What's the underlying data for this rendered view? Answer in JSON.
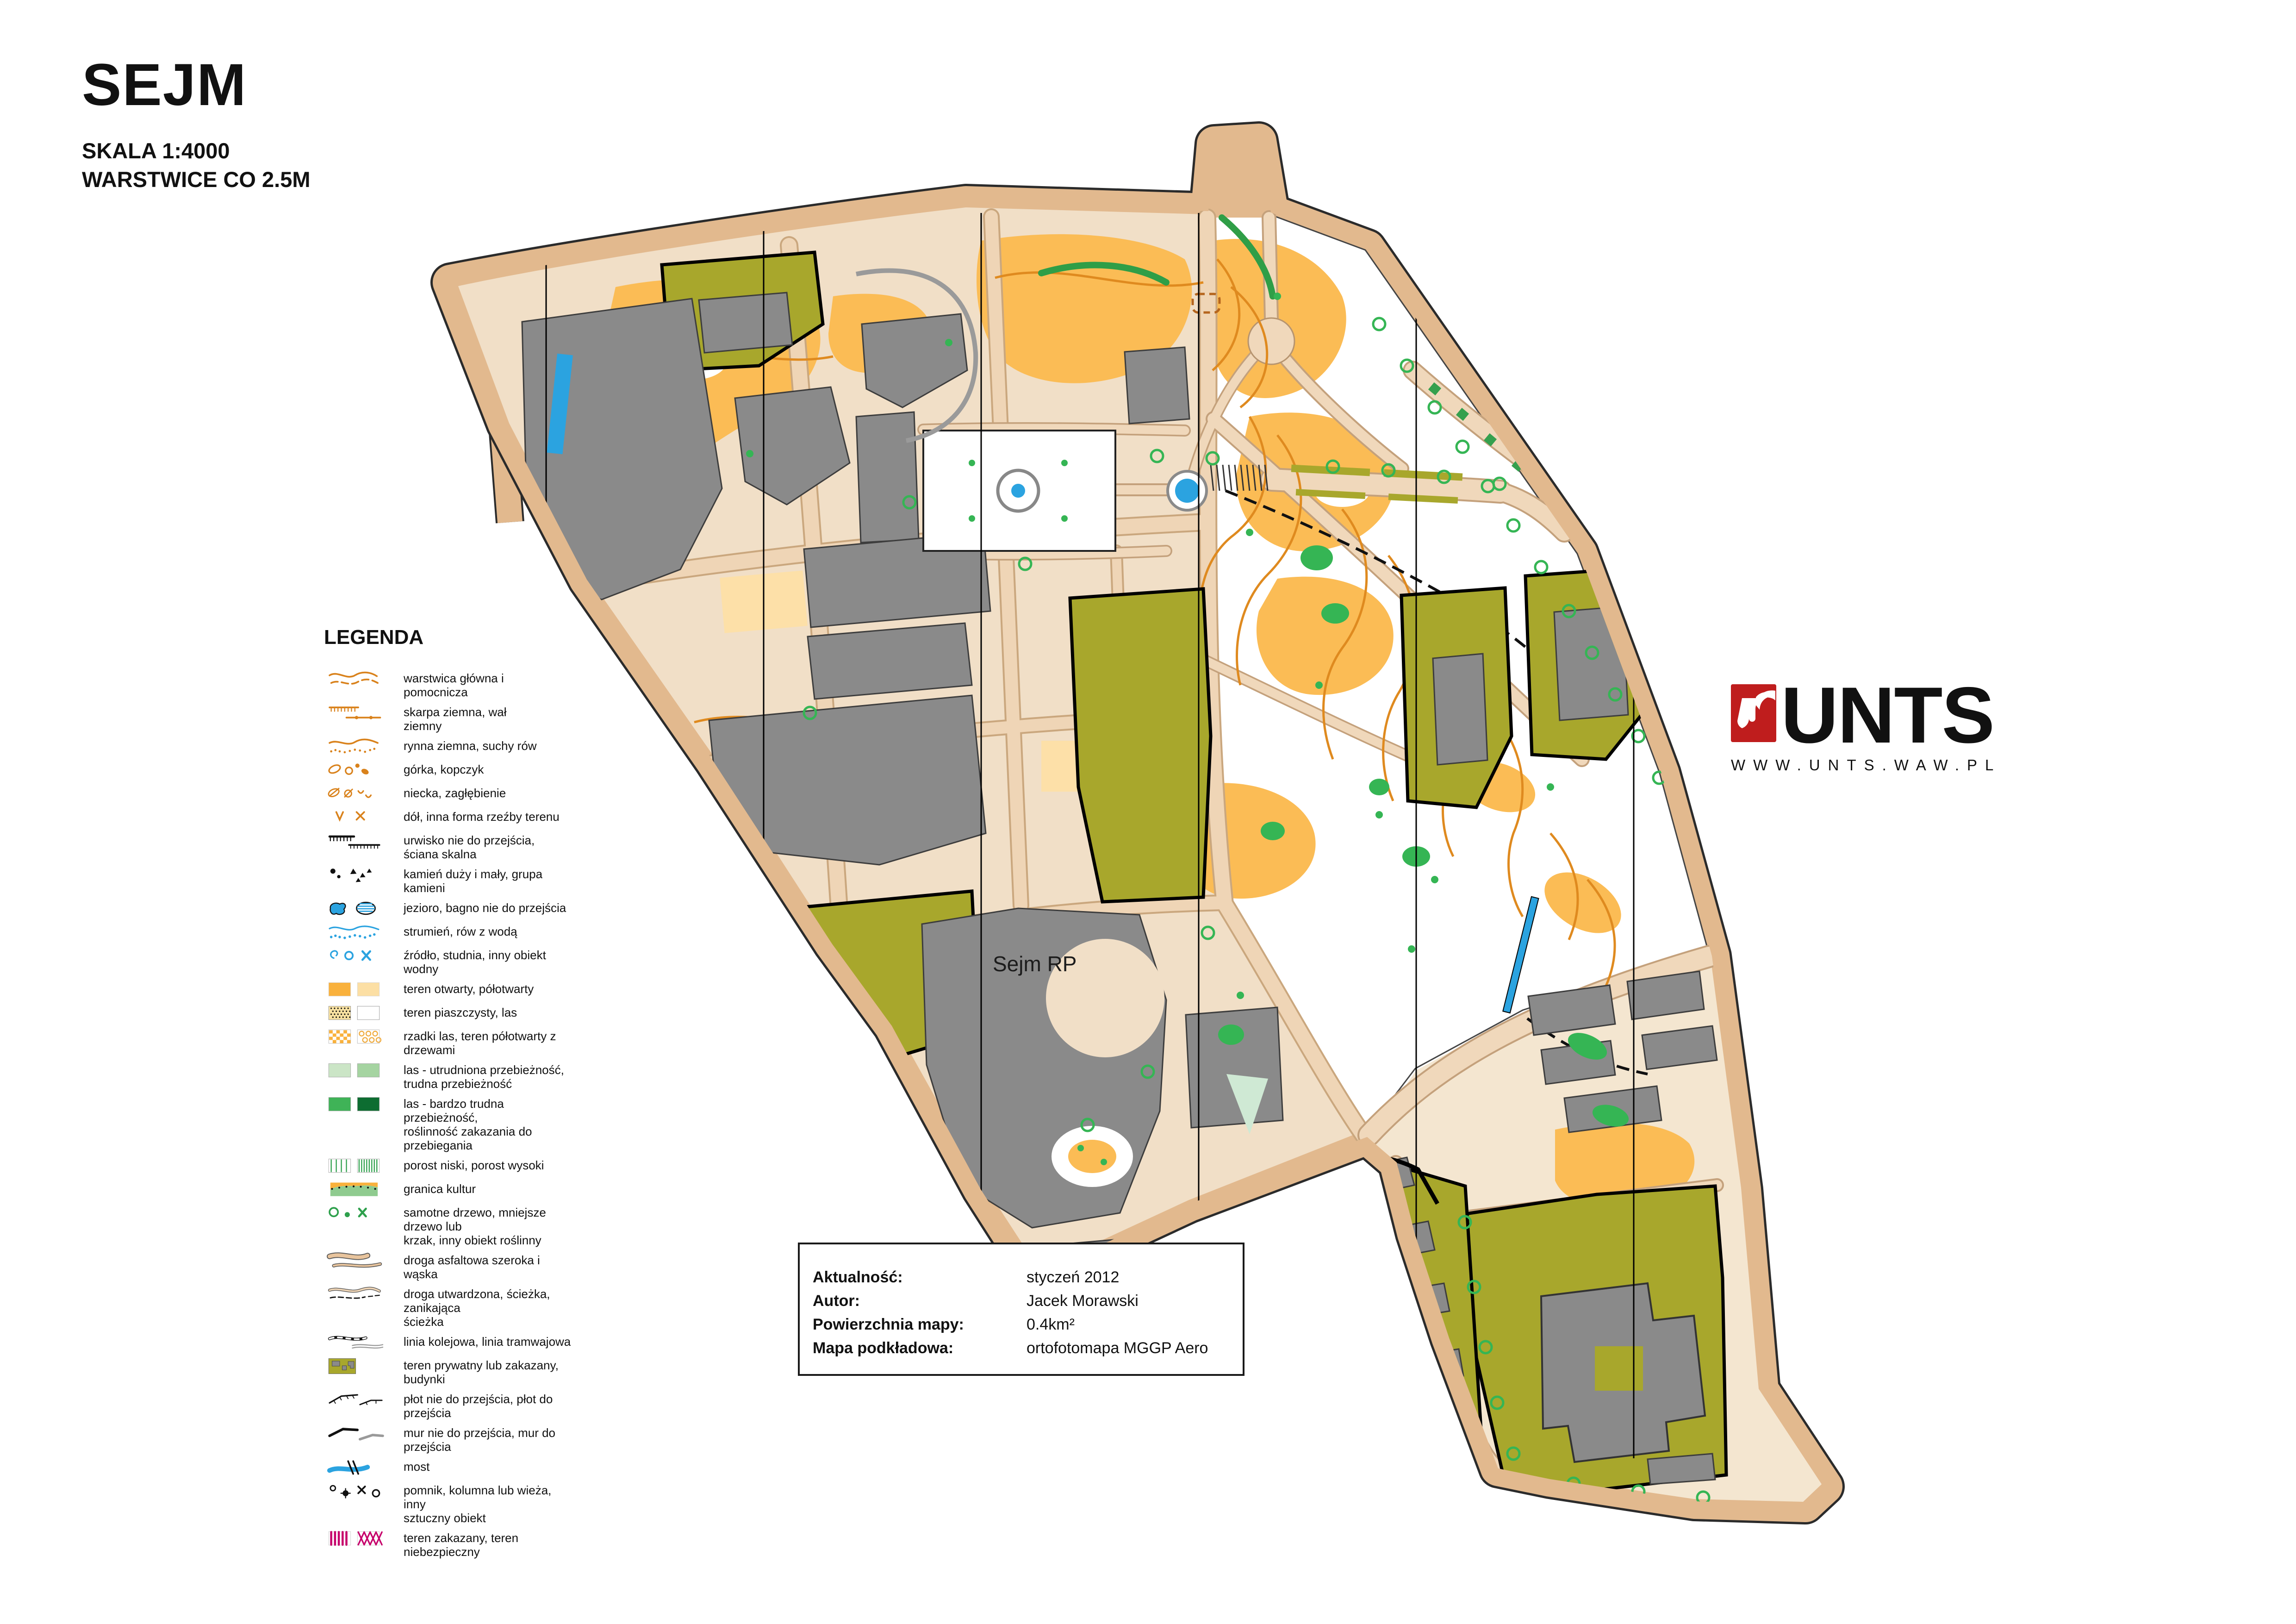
{
  "header": {
    "title": "SEJM",
    "scale_line": "SKALA 1:4000",
    "contour_line": "WARSTWICE CO 2.5M"
  },
  "legend": {
    "heading": "LEGENDA",
    "items": [
      {
        "icon": "contours",
        "label": "warstwica główna i\npomocnicza"
      },
      {
        "icon": "earth-bank",
        "label": "skarpa ziemna, wał\nziemny"
      },
      {
        "icon": "earth-gully",
        "label": "rynna ziemna, suchy rów"
      },
      {
        "icon": "knoll",
        "label": "górka, kopczyk"
      },
      {
        "icon": "depression",
        "label": "niecka, zagłębienie"
      },
      {
        "icon": "pit",
        "label": "dół, inna forma rzeźby terenu"
      },
      {
        "icon": "cliff",
        "label": "urwisko nie do przejścia,\nściana skalna"
      },
      {
        "icon": "stones",
        "label": "kamień duży i mały, grupa\nkamieni"
      },
      {
        "icon": "lake",
        "label": "jezioro, bagno nie do przejścia"
      },
      {
        "icon": "stream",
        "label": "strumień, rów z wodą"
      },
      {
        "icon": "water-point",
        "label": "źródło, studnia, inny obiekt wodny"
      },
      {
        "icon": "open-land",
        "label": "teren otwarty, półotwarty"
      },
      {
        "icon": "sand",
        "label": "teren piaszczysty, las"
      },
      {
        "icon": "rough-open",
        "label": "rzadki las, teren półotwarty z drzewami"
      },
      {
        "icon": "forest-walk",
        "label": "las - utrudniona przebieżność,\ntrudna przebieżność"
      },
      {
        "icon": "forest-fight",
        "label": "las - bardzo trudna przebieżność,\nroślinność zakazania do przebiegania"
      },
      {
        "icon": "undergrowth",
        "label": "porost niski, porost wysoki"
      },
      {
        "icon": "culture-boundary",
        "label": "granica kultur"
      },
      {
        "icon": "tree",
        "label": "samotne drzewo, mniejsze drzewo lub\nkrzak, inny obiekt roślinny"
      },
      {
        "icon": "road-asphalt",
        "label": "droga asfaltowa szeroka i wąska"
      },
      {
        "icon": "path",
        "label": "droga utwardzona, ścieżka, zanikająca\nścieżka"
      },
      {
        "icon": "railway",
        "label": "linia kolejowa, linia tramwajowa"
      },
      {
        "icon": "private",
        "label": "teren prywatny lub zakazany, budynki"
      },
      {
        "icon": "fence",
        "label": "płot nie do przejścia, płot do przejścia"
      },
      {
        "icon": "wall",
        "label": "mur nie do przejścia, mur do przejścia"
      },
      {
        "icon": "bridge",
        "label": "most"
      },
      {
        "icon": "monument",
        "label": "pomnik, kolumna lub wieża, inny\nsztuczny obiekt"
      },
      {
        "icon": "forbidden",
        "label": "teren zakazany, teren niebezpieczny"
      }
    ]
  },
  "map": {
    "sejm_label": "Sejm RP"
  },
  "logo": {
    "text": "UNTS",
    "website": "WWW.UNTS.WAW.PL",
    "mark_color": "#bf1d1d"
  },
  "info_box": {
    "rows": [
      {
        "label": "Aktualność:",
        "value": "styczeń 2012"
      },
      {
        "label": "Autor:",
        "value": "Jacek Morawski"
      },
      {
        "label": "Powierzchnia mapy:",
        "value": "0.4km²"
      },
      {
        "label": "Mapa podkładowa:",
        "value": "ortofotomapa MGGP Aero"
      }
    ]
  },
  "colors": {
    "road_band": "#e2b98e",
    "paved": "#f1dfc7",
    "park_white": "#ffffff",
    "open_orange": "#fbbc55",
    "semi_open": "#fde0a8",
    "olive_private": "#a8a72c",
    "building_gray": "#8a8a8a",
    "vegetation_green": "#35b554",
    "contour_orange": "#df8a1f",
    "water_blue": "#2ba3e0",
    "forbidden_magenta": "#c6006b",
    "symbol_orange": "#d9821c"
  }
}
